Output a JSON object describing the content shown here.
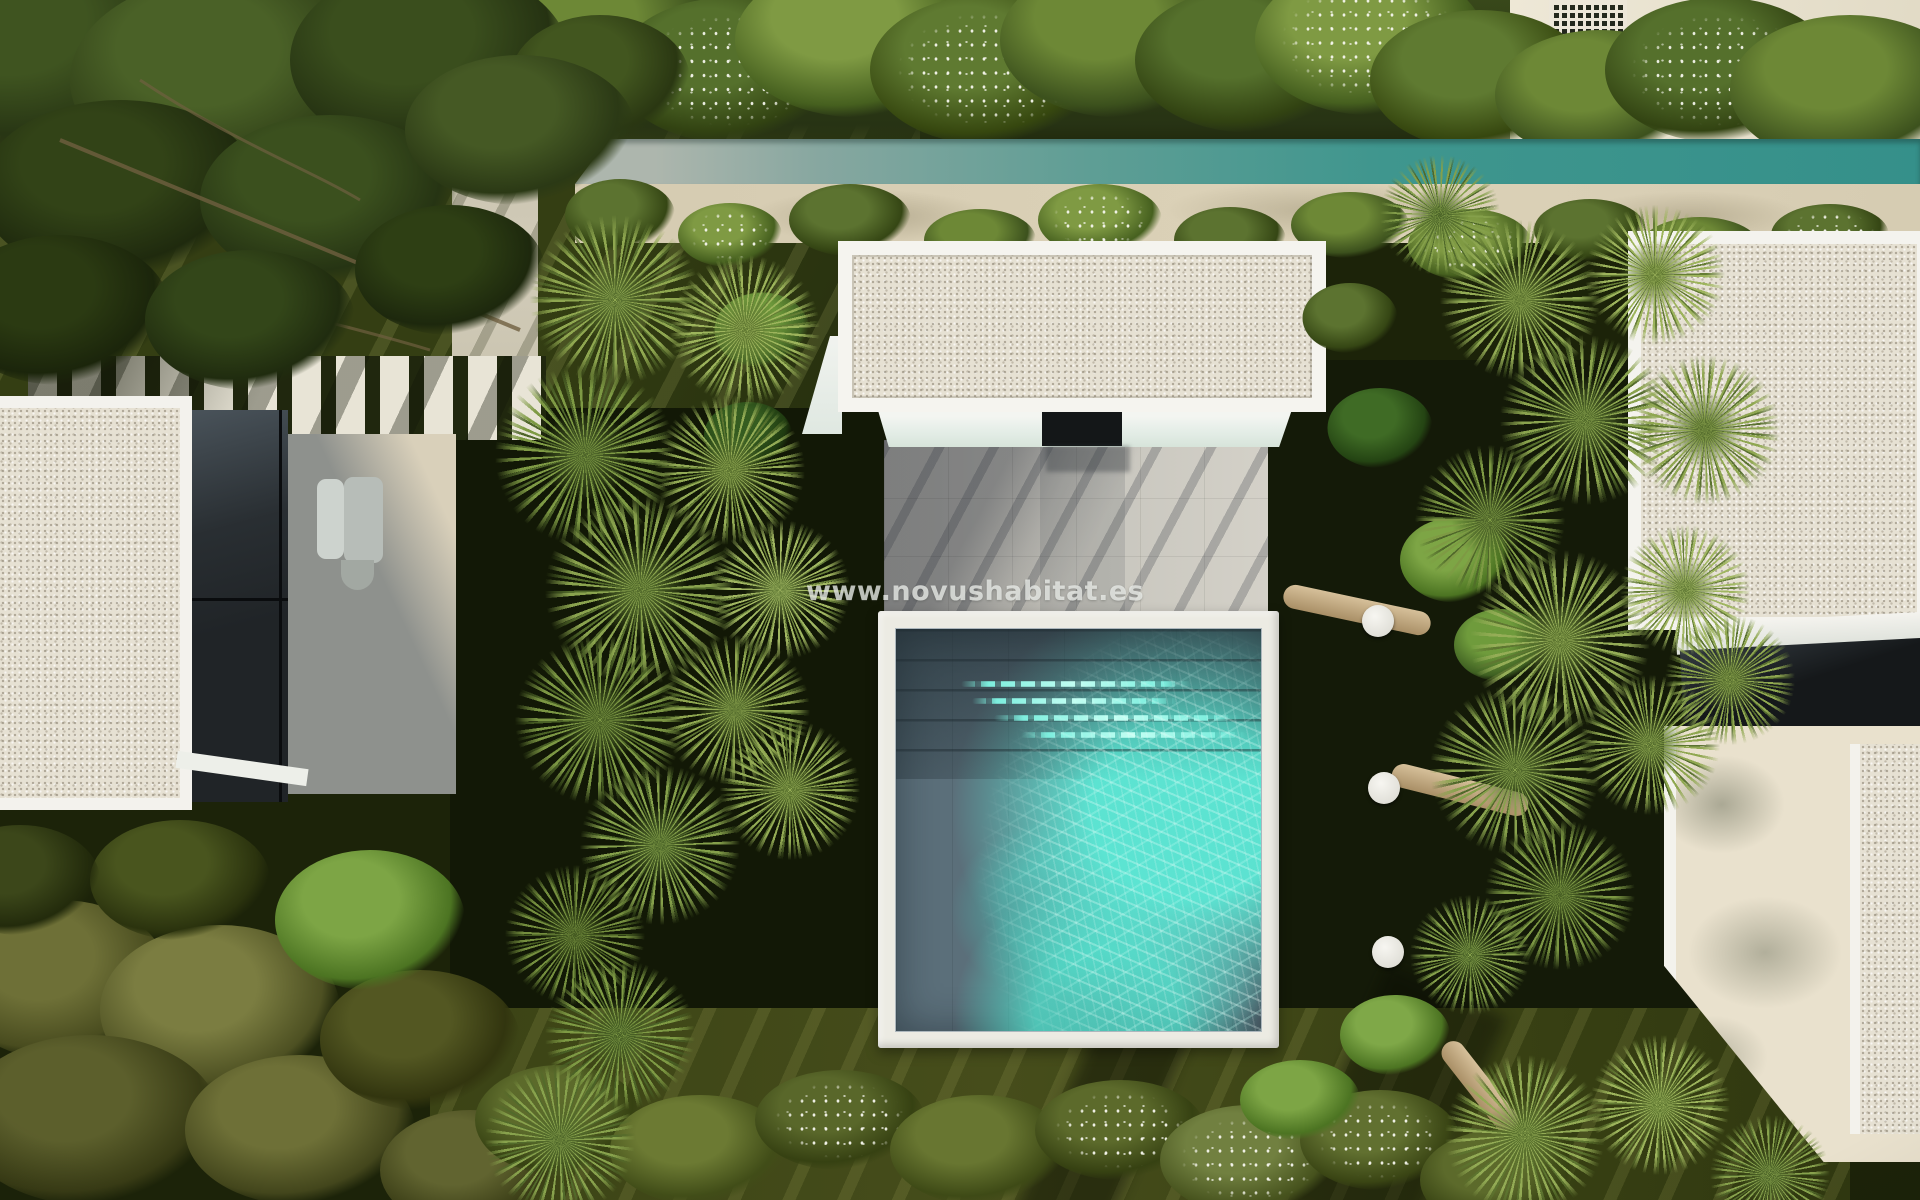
{
  "watermark": {
    "text": "www.novushabitat.es"
  },
  "scene": {
    "description": "Aerial top-down render of a modern villa garden with a square plunge pool, gravel flat roofs, palm trees, hedges and white daybeds",
    "pool": {
      "shadow_water": "#5b6f7a",
      "sunlit_water": "#49d0c0",
      "coping": "#ecebe3",
      "step_glints": 4
    },
    "roofs": {
      "gravel": "#e6e1d3",
      "white_trim": "#f4f3ee"
    },
    "walls": {
      "teal_fence": "#3f968e",
      "beige_fence": "#d9cfb5",
      "upper_wall_cream": "#ebe5d3",
      "breeze_block": "#ece6d8"
    },
    "ground": {
      "lawn_dark": "#1c2309",
      "lawn_lit": "#464d1b",
      "patio_gray": "#c9c7bf",
      "terrace_cream": "#e9e1cd",
      "paver": "#e8e4d6"
    },
    "vegetation": {
      "hedge_green": "#46591f",
      "palm_light": "#9db45c",
      "palm_dark": "#55702c",
      "flower_dots": "#f2f2e6"
    },
    "furniture": {
      "daybed_groups_right": 3,
      "daybed_groups_left": 3,
      "cushions_per_group": 4,
      "side_tables": 3,
      "cushion_color": "#f1efe8",
      "armchair_gray": "#b7bdb8"
    },
    "walkway": {
      "slat_count": 12
    }
  }
}
